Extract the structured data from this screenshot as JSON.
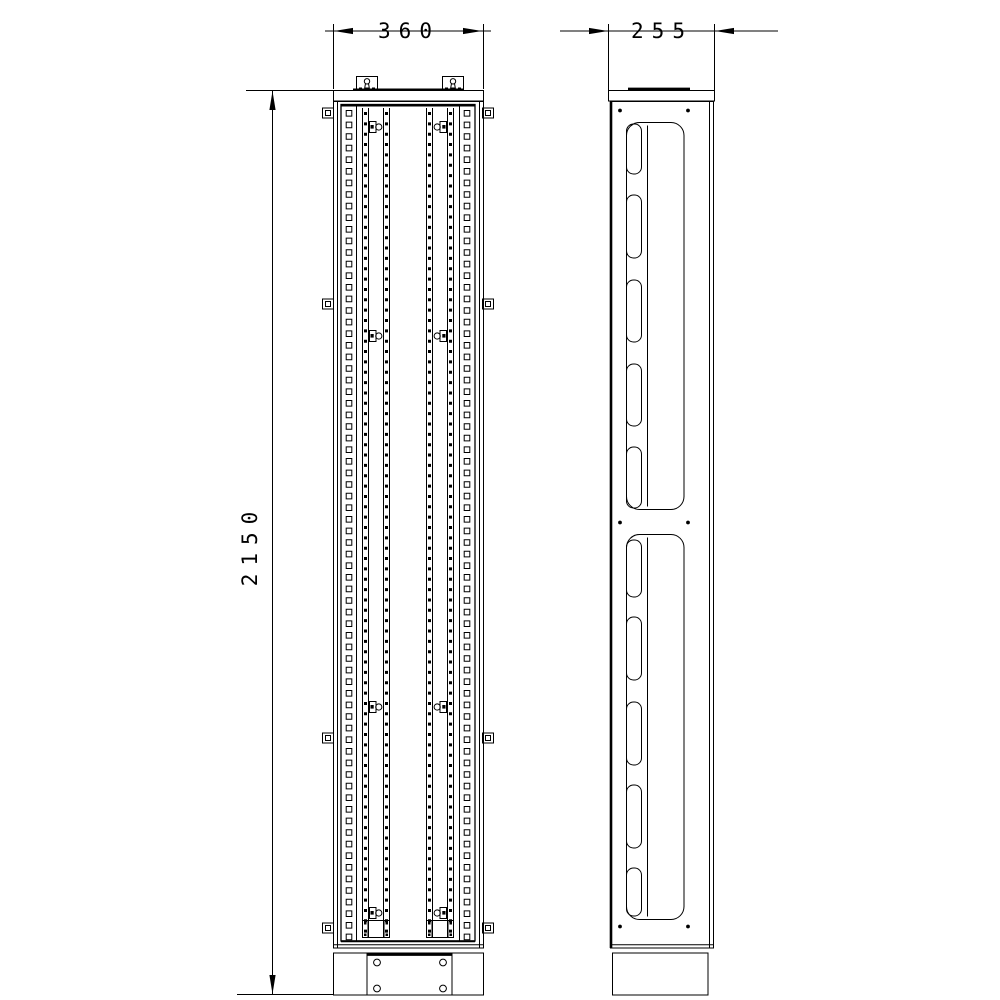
{
  "sheet": {
    "width": 1000,
    "height": 1000,
    "background": "#ffffff",
    "ink": "#000000"
  },
  "drawing_title": "Cabinet frame two-view technical drawing",
  "dimensions": {
    "front_width": {
      "label": "360"
    },
    "side_depth": {
      "label": "255"
    },
    "overall_height": {
      "label": "2150"
    }
  },
  "views": {
    "front": {
      "left": 333,
      "right": 483,
      "top": 90,
      "body_top": 101,
      "body_bottom": 948,
      "top_plate": {
        "h": 10.5,
        "bar": [
          353,
          463,
          89.7
        ]
      },
      "lugs": {
        "xs": [
          356.5,
          442.5
        ],
        "w": 21,
        "y": 76.5,
        "h": 14
      },
      "edge_inset": 4,
      "panel": {
        "x1": 341,
        "x2": 475,
        "y1": 104.5,
        "y2": 941
      },
      "punch_bounds": [
        356.5,
        459.5
      ],
      "big_holes": {
        "cols": [
          349,
          467
        ],
        "size": 5.6,
        "pitch": 11.6,
        "y0": 110.5,
        "count": 72
      },
      "rail_lines": [
        362.5,
        368.5,
        383.5,
        389.5,
        426.5,
        432.5,
        447.5,
        453.5
      ],
      "rail_y": [
        108,
        938
      ],
      "small_holes": {
        "cols": [
          365.5,
          386.5,
          429.5,
          450.5
        ],
        "size": 3,
        "pitch": 10.35,
        "y0": 112,
        "count": 80
      },
      "tabs": {
        "ys": [
          127,
          336,
          707,
          913
        ]
      },
      "clips": {
        "ys": [
          113,
          304,
          738,
          928
        ]
      },
      "brackets": {
        "xs": [
          362.5,
          426.5
        ],
        "y": 920.5,
        "w": 27,
        "h": 17
      },
      "bottom_lines": [
        941.3,
        944.7,
        948
      ],
      "plinth": {
        "y": 953,
        "h": 42,
        "plate": {
          "x1": 367,
          "x2": 452
        },
        "holes": {
          "xs": [
            377,
            443
          ],
          "ys": [
            962.5,
            988.5
          ],
          "r": 3.4
        }
      }
    },
    "side": {
      "left": 610,
      "right": 713,
      "cap": {
        "x1": 608,
        "x2": 714,
        "y": 90,
        "h": 10.5,
        "bar": [
          628,
          690,
          88.8
        ]
      },
      "body_top": 101,
      "body_bottom": 948,
      "inner_right": 709.5,
      "dots": {
        "xs": [
          620,
          688
        ],
        "ys": [
          110.5,
          522.5,
          926.5
        ],
        "r": 1.9
      },
      "duct": {
        "x1": 626.5,
        "x2": 684,
        "r": 13,
        "divider": 647.5,
        "slot_w": 15,
        "slot_r": 7
      },
      "ducts": [
        {
          "y1": 122.5,
          "y2": 509.5,
          "slots": [
            [
              124,
              174
            ],
            [
              195,
              258
            ],
            [
              280,
              342
            ],
            [
              364,
              426
            ],
            [
              447,
              508
            ]
          ]
        },
        {
          "y1": 534.5,
          "y2": 919.5,
          "slots": [
            [
              540,
              597
            ],
            [
              617,
              680
            ],
            [
              702,
              765
            ],
            [
              785,
              848
            ],
            [
              868,
              916
            ]
          ]
        }
      ],
      "bottom_lines": [
        944.7,
        948
      ],
      "plinth": {
        "x1": 612.5,
        "x2": 708,
        "y": 953,
        "h": 42
      }
    },
    "dims": {
      "d360": {
        "line": [
          325,
          491,
          31
        ],
        "ext": [
          [
            333.5,
            24,
            89
          ],
          [
            483.5,
            24,
            89
          ]
        ],
        "arrows": [
          {
            "tip": [
              334,
              31
            ],
            "dx": 1
          },
          {
            "tip": [
              482,
              31
            ],
            "dx": -1
          }
        ],
        "label_pos": [
          409,
          38
        ]
      },
      "d255": {
        "line": [
          560,
          778,
          31
        ],
        "ext": [
          [
            608.5,
            24,
            98
          ],
          [
            714.5,
            24,
            98
          ]
        ],
        "arrows": [
          {
            "tip": [
              608,
              31
            ],
            "dx": -1
          },
          {
            "tip": [
              715,
              31
            ],
            "dx": 1
          }
        ],
        "label_pos": [
          662,
          38
        ]
      },
      "d2150": {
        "line": [
          272.5,
          91,
          994
        ],
        "ext_h": [
          [
            246,
            333,
            90.5
          ],
          [
            237,
            334,
            994.5
          ]
        ],
        "arrows": [
          {
            "tip": [
              272.5,
              91
            ],
            "dy": 1
          },
          {
            "tip": [
              272.5,
              994
            ],
            "dy": -1
          }
        ],
        "label_pos": [
          257,
          545
        ]
      }
    }
  }
}
